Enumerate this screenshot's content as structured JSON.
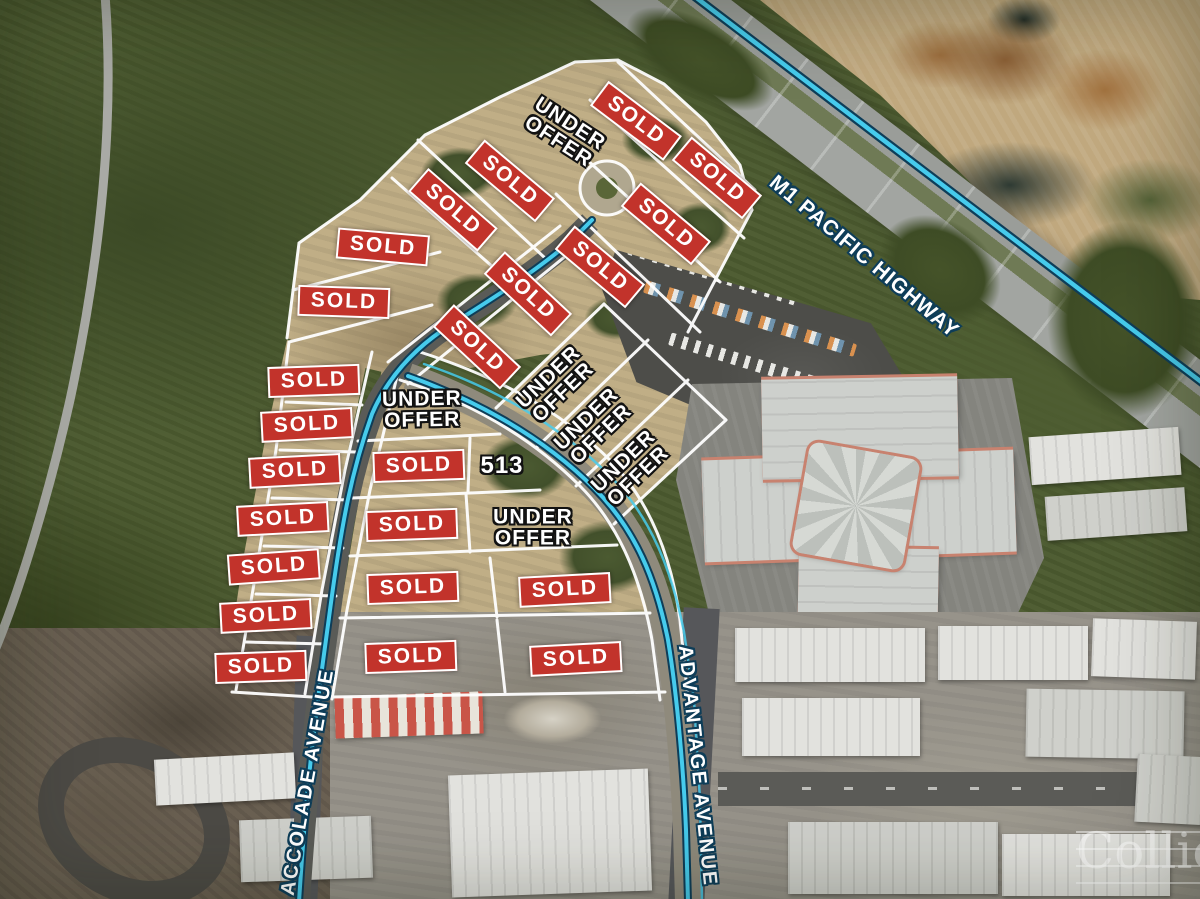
{
  "map": {
    "badges": {
      "sold_label": "SOLD",
      "under_offer_label": "UNDER OFFER"
    },
    "sold_lots": [
      {
        "x": 636,
        "y": 121,
        "r": 37
      },
      {
        "x": 717,
        "y": 178,
        "r": 40
      },
      {
        "x": 510,
        "y": 181,
        "r": 40
      },
      {
        "x": 453,
        "y": 210,
        "r": 41
      },
      {
        "x": 666,
        "y": 224,
        "r": 40
      },
      {
        "x": 383,
        "y": 247,
        "r": 5
      },
      {
        "x": 600,
        "y": 267,
        "r": 40
      },
      {
        "x": 344,
        "y": 302,
        "r": 2
      },
      {
        "x": 528,
        "y": 294,
        "r": 43
      },
      {
        "x": 477,
        "y": 347,
        "r": 43
      },
      {
        "x": 314,
        "y": 381,
        "r": -2
      },
      {
        "x": 307,
        "y": 425,
        "r": -3
      },
      {
        "x": 295,
        "y": 471,
        "r": -3
      },
      {
        "x": 283,
        "y": 519,
        "r": -3
      },
      {
        "x": 274,
        "y": 567,
        "r": -4
      },
      {
        "x": 266,
        "y": 616,
        "r": -3
      },
      {
        "x": 261,
        "y": 667,
        "r": -2
      },
      {
        "x": 419,
        "y": 466,
        "r": -2
      },
      {
        "x": 412,
        "y": 525,
        "r": -2
      },
      {
        "x": 413,
        "y": 588,
        "r": -2
      },
      {
        "x": 565,
        "y": 590,
        "r": -3
      },
      {
        "x": 411,
        "y": 657,
        "r": -2
      },
      {
        "x": 576,
        "y": 659,
        "r": -3
      }
    ],
    "under_offer_lots": [
      {
        "x": 564,
        "y": 133,
        "r": 33
      },
      {
        "x": 422,
        "y": 410,
        "r": -1
      },
      {
        "x": 556,
        "y": 385,
        "r": -44
      },
      {
        "x": 594,
        "y": 427,
        "r": -44
      },
      {
        "x": 631,
        "y": 469,
        "r": -44
      },
      {
        "x": 533,
        "y": 528,
        "r": 0
      }
    ],
    "lot_number": "513",
    "streets": {
      "highway": "M1 PACIFIC HIGHWAY",
      "left": "ACCOLADE AVENUE",
      "right": "ADVANTAGE AVENUE"
    },
    "watermark": "Colliers",
    "colors": {
      "sold_red": "#c2332b",
      "line_white": "#ffffff",
      "road_cyan": "#46cbec",
      "outline_navy": "#0e3d58",
      "outline_black": "#121212"
    }
  }
}
